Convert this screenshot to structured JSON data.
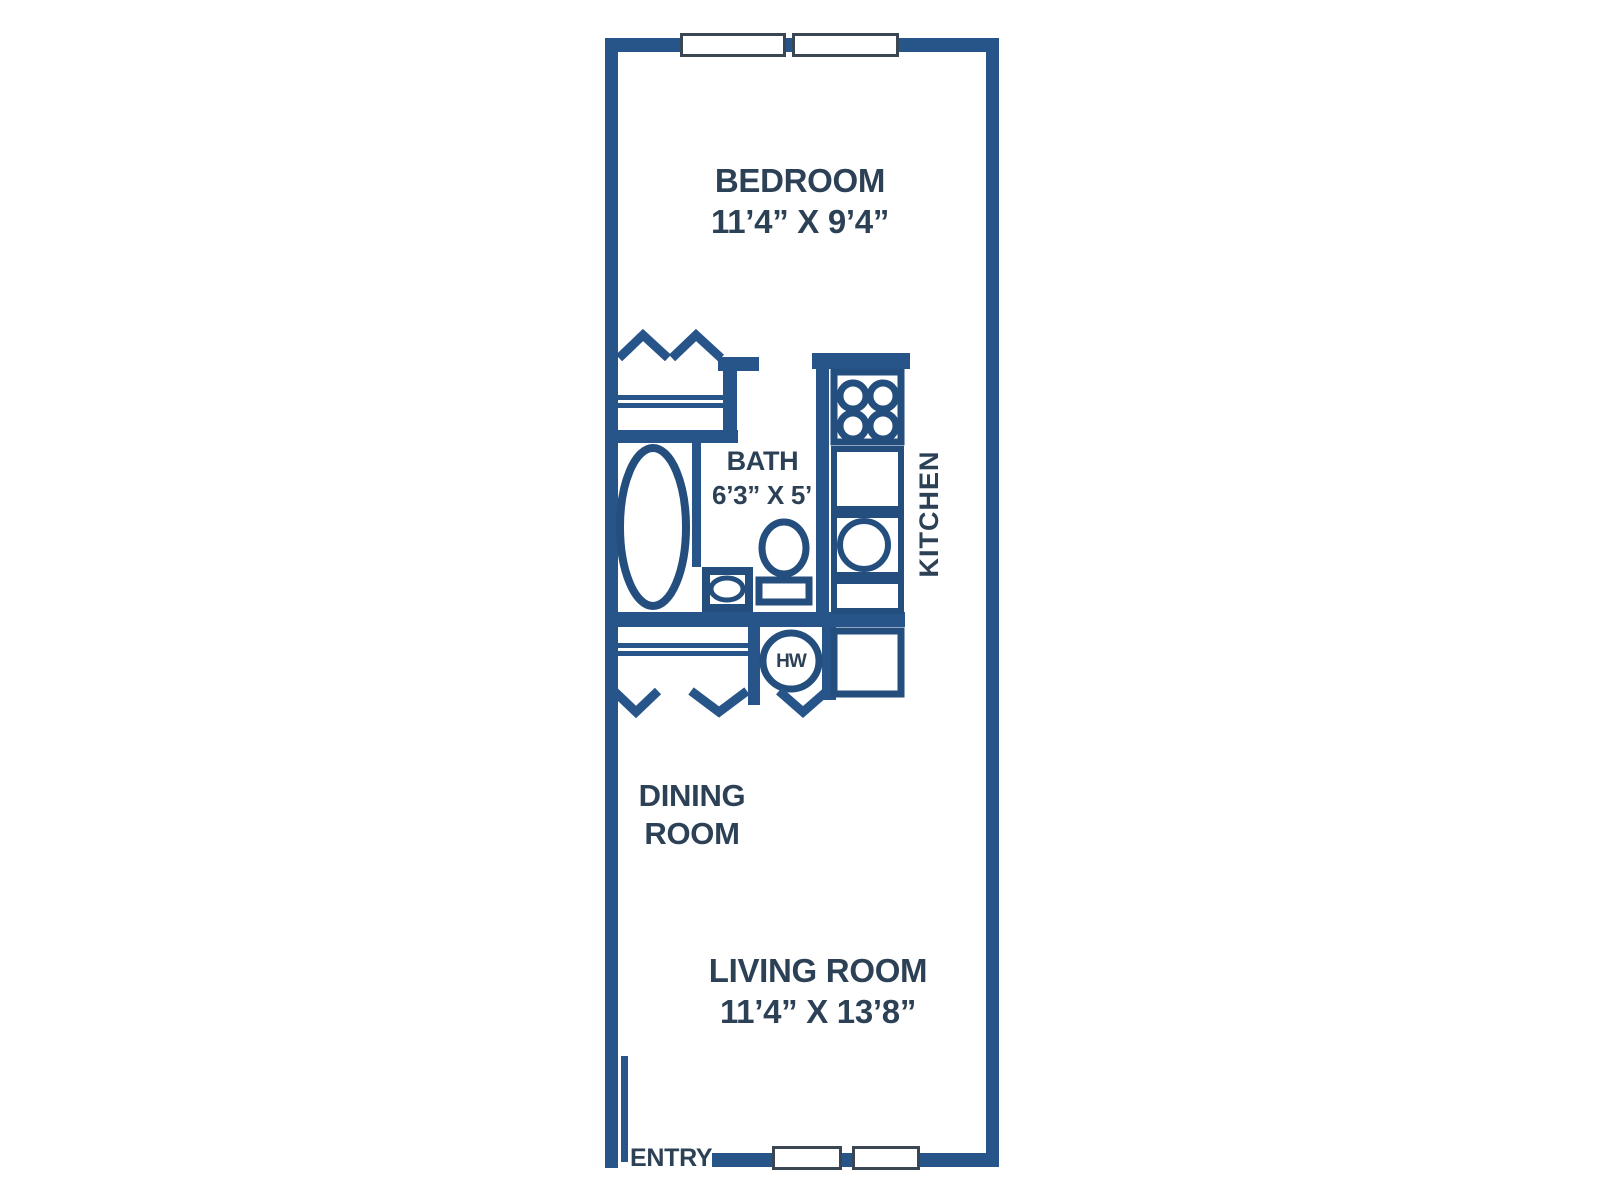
{
  "colors": {
    "wall": "#27558a",
    "fixture_stroke": "#234e7e",
    "text": "#2d4156",
    "window_border": "#3a4753",
    "background": "#ffffff"
  },
  "rooms": {
    "bedroom": {
      "label": "BEDROOM",
      "dims": "11’4” X 9’4”"
    },
    "bath": {
      "label": "BATH",
      "dims": "6’3” X 5’"
    },
    "kitchen": {
      "label": "KITCHEN"
    },
    "dining": {
      "line1": "DINING",
      "line2": "ROOM"
    },
    "living": {
      "label": "LIVING ROOM",
      "dims": "11’4” X 13’8”"
    }
  },
  "labels": {
    "entry": "ENTRY",
    "water_heater": "HW"
  },
  "fixture_names": [
    "bathtub",
    "toilet",
    "bathroom-sink",
    "kitchen-sink",
    "stove-4-burner",
    "water-heater",
    "bedroom-closet-shelf",
    "linen-closet-shelf",
    "bifold-door-chevrons",
    "window",
    "entry-door-leaf"
  ]
}
